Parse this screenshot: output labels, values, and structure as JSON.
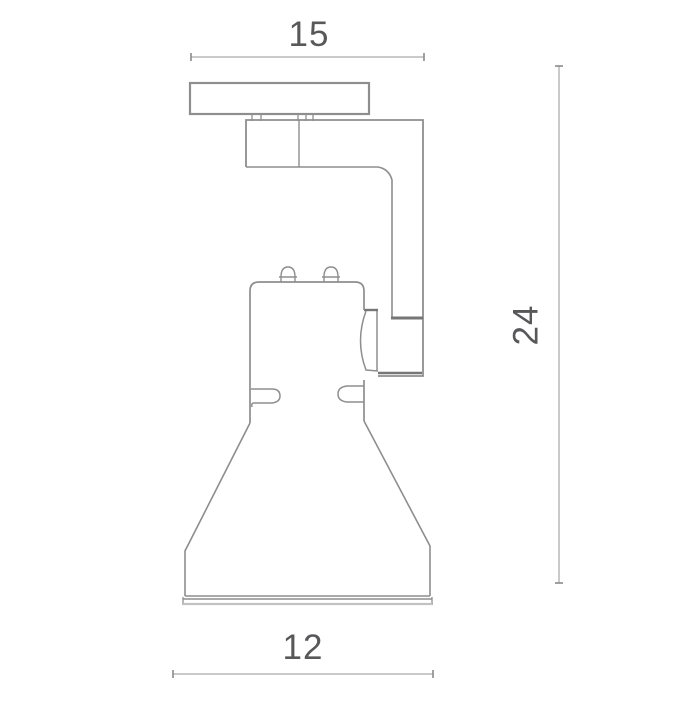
{
  "page": {
    "type": "technical-dimension-drawing",
    "subject": "track-mounted spotlight, side elevation view"
  },
  "dimensions": {
    "top_width": {
      "label": "15",
      "orientation": "horizontal",
      "position": "top"
    },
    "height": {
      "label": "24",
      "orientation": "vertical",
      "position": "right"
    },
    "bottom_width": {
      "label": "12",
      "orientation": "horizontal",
      "position": "bottom"
    }
  },
  "parts": {
    "mounting_plate": "track mounting plate",
    "connector_tabs": "plate-to-arm connector tabs",
    "mounting_arm": "L-shaped support arm",
    "swivel_joint": "swivel joint block",
    "lamp_body": "lamp housing with adjustment knobs and clips",
    "lamp_shade": "conical reflector shade with front rim"
  },
  "colors": {
    "background": "#ffffff",
    "outline": "#8e8e8e",
    "outline_dark": "#767676",
    "dimension_line": "#b9b9b9",
    "dimension_tick": "#8a8a8a",
    "label_text": "#58585a",
    "rim_light": "#c2c2c2"
  }
}
